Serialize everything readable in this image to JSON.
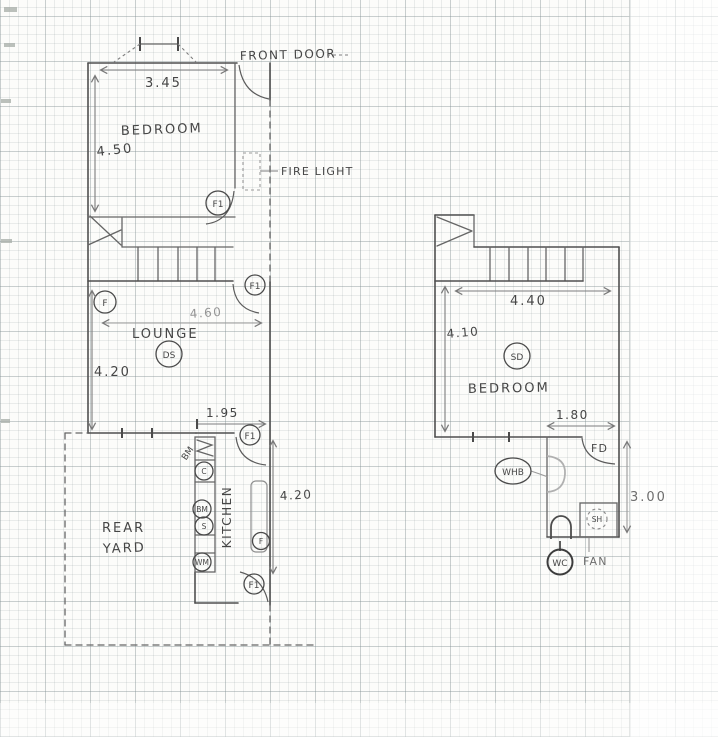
{
  "ground_floor": {
    "front_door_label": "FRONT DOOR",
    "window_width": "3.45",
    "bedroom_label": "BEDROOM",
    "bedroom_height": "4.50",
    "fire_light_label": "FIRE LIGHT",
    "bedroom_door_tag": "F1",
    "stairs_door_tag": "F1",
    "lounge_label": "LOUNGE",
    "lounge_width": "4.60",
    "lounge_height": "4.20",
    "lounge_window_tag": "F",
    "lounge_detector_tag": "DS",
    "kitchen_label": "KITCHEN",
    "kitchen_door_width": "1.95",
    "kitchen_height": "4.20",
    "kitchen_top_door_tag": "F1",
    "kitchen_window_tag": "F",
    "kitchen_bottom_door_tag": "F1",
    "counter_note": "BM",
    "appliances": [
      "C",
      "BM",
      "S",
      "WM"
    ],
    "rear_yard_line1": "REAR",
    "rear_yard_line2": "YARD"
  },
  "first_floor": {
    "stairs_width": "4.40",
    "bedroom_depth": "4.10",
    "bedroom_label": "BEDROOM",
    "smoke_detector_tag": "SD",
    "bathroom_width": "1.80",
    "bathroom_depth": "3.00",
    "fire_door_tag": "FD",
    "basin_tag": "WHB",
    "shower_tag": "SH",
    "toilet_tag": "WC",
    "fan_label": "FAN"
  },
  "colors": {
    "pencil": "#4f4f4f",
    "pencil_light": "#9a9a9a",
    "paper": "#fcfcfa"
  }
}
